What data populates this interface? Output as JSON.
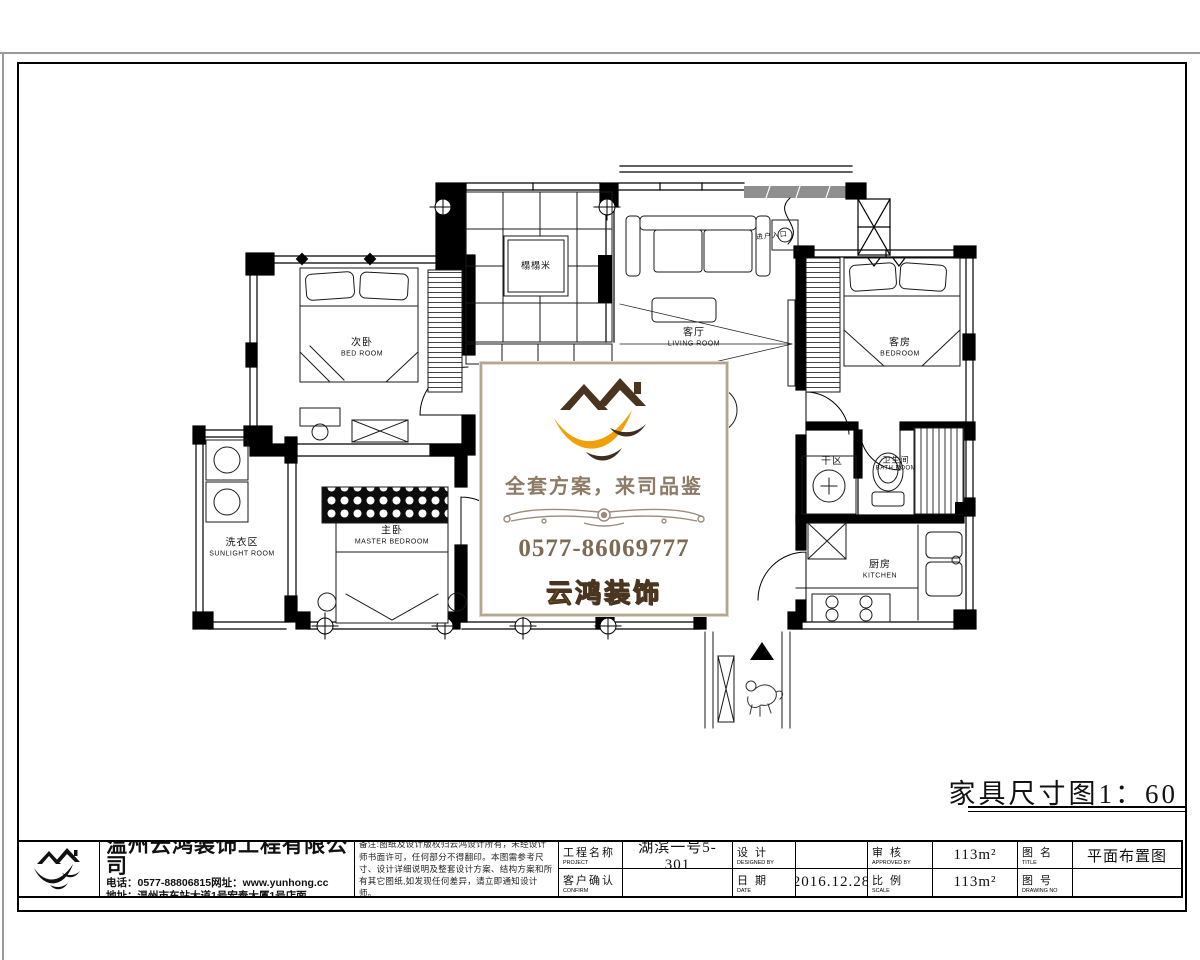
{
  "drawing": {
    "scale_caption": "家具尺寸图1：60",
    "rooms": {
      "bedroom2_cn": "次卧",
      "bedroom2_en": "BED ROOM",
      "tatami": "榻榻米",
      "living_cn": "客厅",
      "living_en": "LIVING ROOM",
      "guest_cn": "客房",
      "guest_en": "BEDROOM",
      "dry_cn": "干区",
      "bath_cn": "卫生间",
      "bath_en": "BATH ROOM",
      "kitchen_cn": "厨房",
      "kitchen_en": "KITCHEN",
      "master_cn": "主卧",
      "master_en": "MASTER BEDROOM",
      "sunlight_cn": "洗衣区",
      "sunlight_en": "SUNLIGHT ROOM",
      "entry_note": "进户入口"
    }
  },
  "watermark": {
    "slogan": "全套方案，来司品鉴",
    "phone": "0577-86069777",
    "brand": "云鸿装饰",
    "brand_color": "#f59a00",
    "accent_dark": "#4a3420",
    "accent_orange": "#f2a007"
  },
  "titleblock": {
    "company": {
      "name": "温州云鸿装饰工程有限公司",
      "contact_line": "电话：0577-88806815网址：www.yunhong.cc",
      "address_line": "地址：温州市车站大道1号宏泰大厦1号店面"
    },
    "note_lines": "备注:图纸及设计版权归云鸿设计所有，未经设计师书面许可，任何部分不得翻印。本图需参考尺寸、设计详细说明及整套设计方案、结构方案和所有其它图纸,如发现任何差异，请立即通知设计师。",
    "fields": {
      "project_label_cn": "工程名称",
      "project_label_en": "PROJECT",
      "project_value": "湖滨一号5-301",
      "confirm_label_cn": "客户确认",
      "confirm_label_en": "CONFIRM",
      "confirm_value": "",
      "design_label_cn": "设 计",
      "design_label_en": "DESIGNED BY",
      "design_value": "",
      "date_label_cn": "日 期",
      "date_label_en": "DATE",
      "date_value": "2016.12.28",
      "approve_label_cn": "审 核",
      "approve_label_en": "APPROVED BY",
      "approve_value": "113m²",
      "scale_label_cn": "比 例",
      "scale_label_en": "SCALE",
      "scale_value": "113m²",
      "title_label_cn": "图 名",
      "title_label_en": "TITLE",
      "title_value": "平面布置图",
      "number_label_cn": "图 号",
      "number_label_en": "DRAWING NO",
      "number_value": ""
    }
  }
}
